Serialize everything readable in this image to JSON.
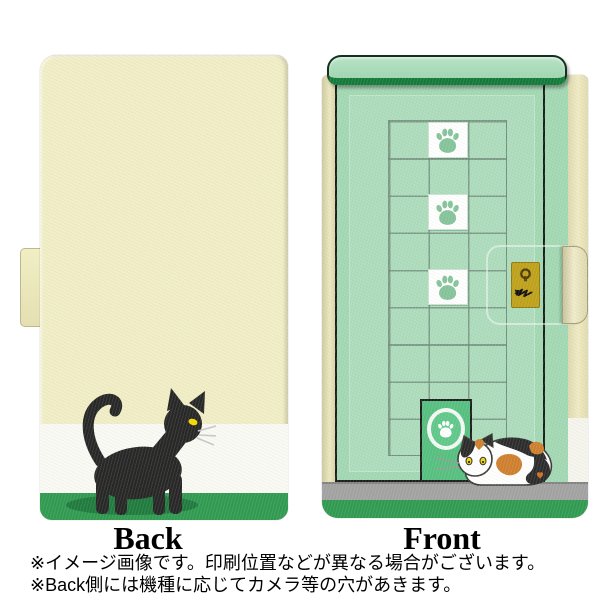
{
  "image": {
    "back_label": "Back",
    "front_label": "Front",
    "notes": [
      "※イメージ画像です。印刷位置などが異なる場合がございます。",
      "※Back側には機種に応じてカメラ等の穴があきます。"
    ]
  },
  "artwork": {
    "back_design": "black cat walking on cream background with white stripe and green ground",
    "front_design": "mint green door with tile grid, paw-print tiles, cat door and calico cat",
    "paw_tile_rows": [
      1,
      3,
      5
    ]
  },
  "colors": {
    "back_cream": "#f1eec6",
    "back_white_band": "#fafaf4",
    "band_green": "#2f9a50",
    "front_mint": "#a2d8b3",
    "lintel_green_dark": "#127a39",
    "cat_door_green": "#55c07f",
    "floor_gray": "#a2a2a2",
    "spine_beige": "#e9e5bd",
    "lock_gold": "#bfa11a",
    "paw_green": "#85c49b",
    "black_cat": "#262626",
    "calico_orange": "#cf7f2e",
    "cat_eye_yellow": "#f5d800",
    "shadow_green": "#1f7a3d"
  },
  "icons": [
    "paw-print-icon",
    "keyhole-icon",
    "scratch-marks-icon",
    "black-cat-illustration",
    "calico-cat-illustration"
  ]
}
